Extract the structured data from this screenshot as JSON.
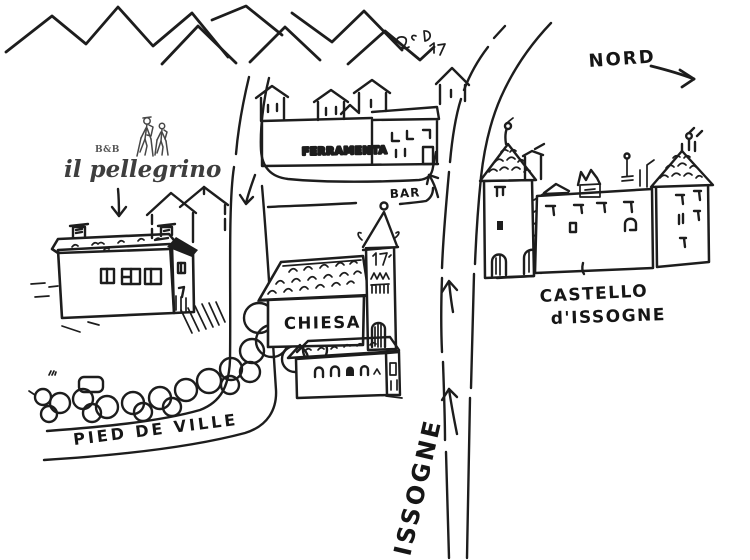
{
  "map": {
    "brand": {
      "bnb": "B&B",
      "name": "il pellegrino"
    },
    "labels": {
      "north": "NORD",
      "hardware_store": "FERRAMENTA",
      "bar": "BAR",
      "church": "CHIESA",
      "castle_line1": "CASTELLO",
      "castle_line2": "d'ISSOGNE",
      "street": "PIED DE VILLE",
      "road": "ISSOGNE"
    },
    "colors": {
      "ink": "#1d1d1d",
      "bnb_building_fill": "#a9cdd4",
      "logo_ink": "#474747",
      "background": "#ffffff"
    }
  }
}
